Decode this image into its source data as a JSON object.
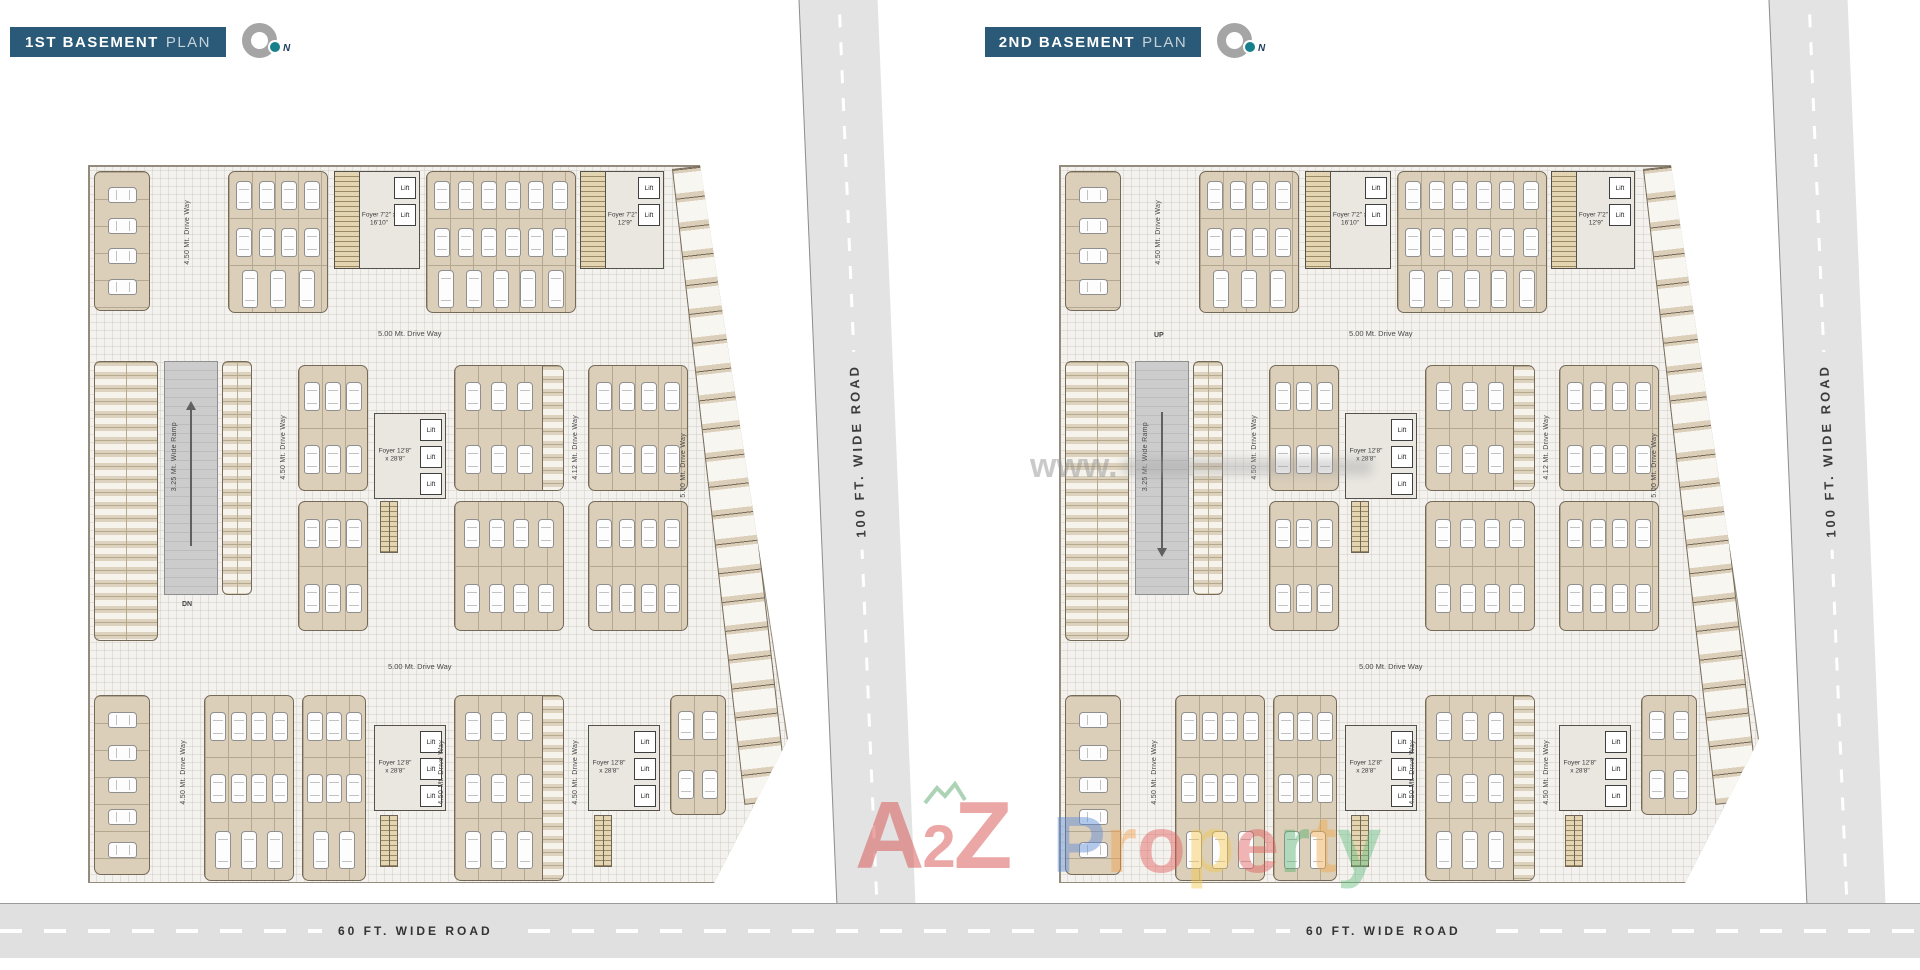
{
  "panels": [
    {
      "id": "basement1",
      "title_bold": "1ST BASEMENT",
      "title_light": "PLAN",
      "compass_n": "N"
    },
    {
      "id": "basement2",
      "title_bold": "2ND BASEMENT",
      "title_light": "PLAN",
      "compass_n": "N"
    }
  ],
  "roads": {
    "vertical_label": "100 FT. WIDE ROAD",
    "bottom_label": "60 FT. WIDE ROAD"
  },
  "plan_labels": {
    "driveway_500": "5.00 Mt. Drive Way",
    "driveway_450": "4.50 Mt. Drive Way",
    "driveway_412": "4.12 Mt. Drive Way",
    "ramp": "3.25 Mt. Wide Ramp",
    "down": "DN",
    "up": "UP",
    "foyer_small_a": "Foyer 7'2\" x 16'10\"",
    "foyer_small_b": "Foyer 7'2\" x 12'9\"",
    "foyer_large": "Foyer 12'8\" x 28'8\"",
    "lift": "Lift"
  },
  "watermarks": {
    "www": "www.",
    "brand_a": "A",
    "brand_2": "2",
    "brand_z": "Z",
    "brand_a2z_color": "#d94f4f",
    "brand_property_letters": [
      {
        "ch": "P",
        "color": "#5b8bd9"
      },
      {
        "ch": "r",
        "color": "#f0a14e"
      },
      {
        "ch": "o",
        "color": "#e25c5c"
      },
      {
        "ch": "p",
        "color": "#f2c84b"
      },
      {
        "ch": "e",
        "color": "#e25c5c"
      },
      {
        "ch": "r",
        "color": "#57b06e"
      },
      {
        "ch": "t",
        "color": "#f0a84a"
      },
      {
        "ch": "y",
        "color": "#63bd7e"
      }
    ]
  },
  "colors": {
    "title_bg": "#2a5a78",
    "compass_dot": "#15808c",
    "road_bg": "#e3e3e3",
    "stall_tan": "#dbcfba",
    "ramp_gray": "#c7c7c7"
  }
}
